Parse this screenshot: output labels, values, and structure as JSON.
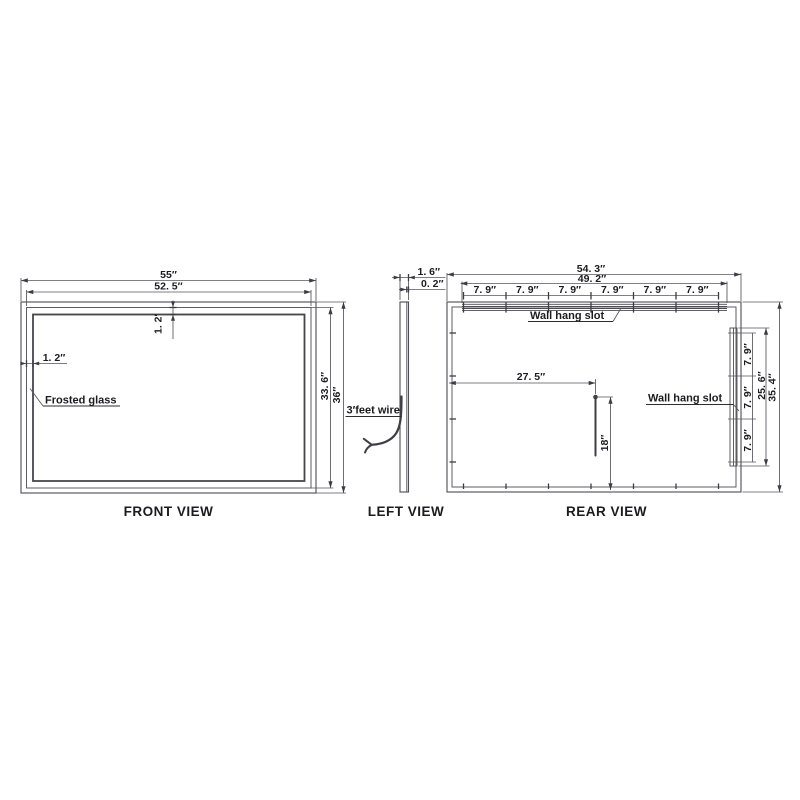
{
  "colors": {
    "background": "#ffffff",
    "line": "#4c4c54",
    "text": "#1c1c20"
  },
  "front_view": {
    "caption": "FRONT VIEW",
    "dim_overall_width": "55″",
    "dim_glass_width": "52. 5″",
    "dim_frame_top": "1. 2′",
    "dim_frame_left": "1. 2″",
    "dim_glass_height": "33. 6″",
    "dim_overall_height": "36″",
    "label_glass": "Frosted glass"
  },
  "left_view": {
    "caption": "LEFT VIEW",
    "dim_depth": "1. 6″",
    "dim_glass_thickness": "0. 2″",
    "label_wire": "3′feet wire"
  },
  "rear_view": {
    "caption": "REAR VIEW",
    "dim_overall_width": "54. 3″",
    "dim_slot_span": "49. 2″",
    "hook_spacings": [
      "7. 9″",
      "7. 9″",
      "7. 9″",
      "7. 9″",
      "7. 9″",
      "7. 9″"
    ],
    "label_top_slot": "Wall hang slot",
    "label_side_slot": "Wall hang slot",
    "dim_wire_offset": "27. 5″",
    "dim_wire_length": "18″",
    "side_spacings": [
      "7. 9″",
      "7. 9″",
      "7. 9″"
    ],
    "dim_side_slot_span": "25. 6″",
    "dim_overall_height": "35. 4″"
  }
}
